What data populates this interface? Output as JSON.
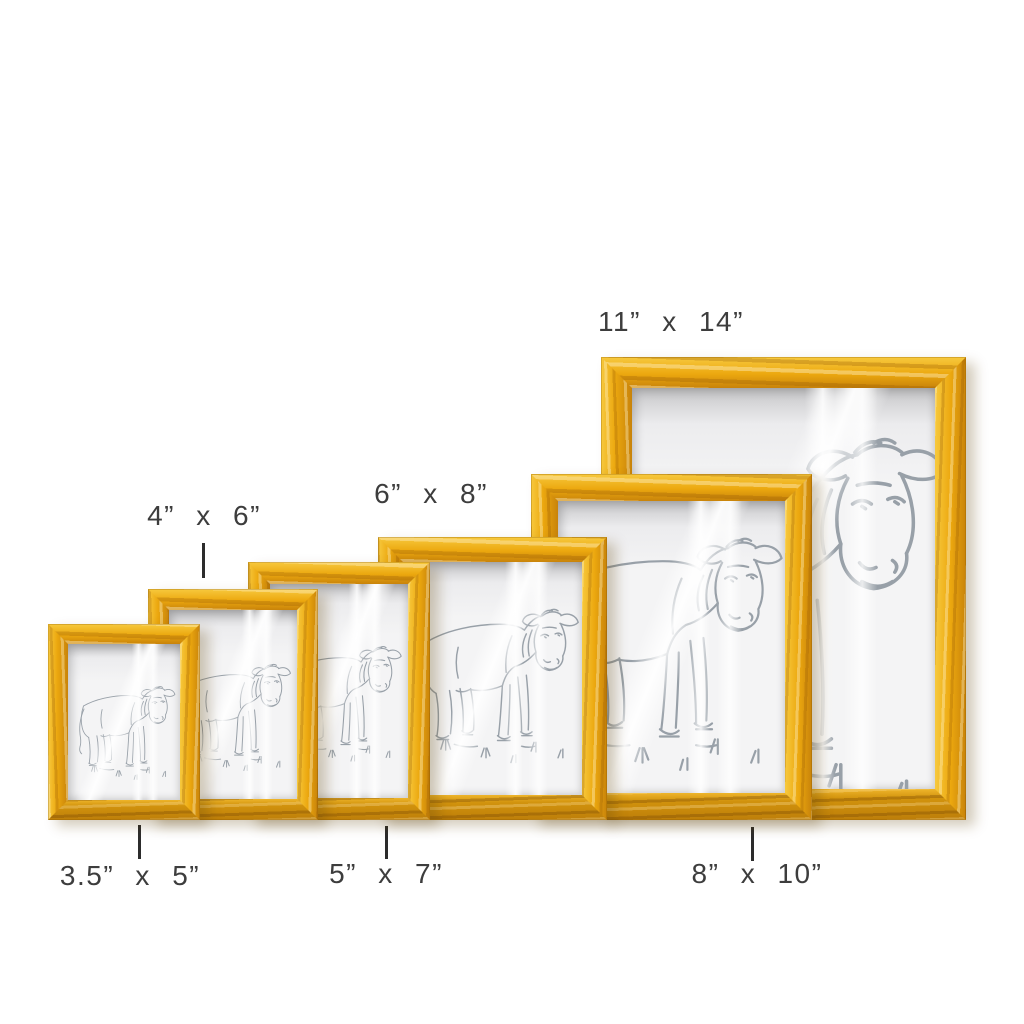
{
  "scene": {
    "background": "#ffffff",
    "artwork_subject": "pencil line sketch of a standing bull with grass tufts"
  },
  "colors": {
    "wood-light": "#f7c93e",
    "wood-main": "#eca80f",
    "wood-dark": "#c8830a",
    "wood-bottom": "#d2930d",
    "paper": "#f4f4f5",
    "paper-shadow": "#c6c6c8",
    "sketch": "#98a0a8",
    "label-text": "#3d3d3d",
    "pointer-line": "#2c2c2c",
    "background": "#ffffff"
  },
  "frames": [
    {
      "size_label": "3.5” x 5”",
      "label_placement": "below",
      "has_pointer_line": true
    },
    {
      "size_label": "4” x 6”",
      "label_placement": "above",
      "has_pointer_line": true
    },
    {
      "size_label": "5” x 7”",
      "label_placement": "below",
      "has_pointer_line": true
    },
    {
      "size_label": "6” x 8”",
      "label_placement": "above",
      "has_pointer_line": false
    },
    {
      "size_label": "8” x 10”",
      "label_placement": "below",
      "has_pointer_line": true
    },
    {
      "size_label": "11” x 14”",
      "label_placement": "above",
      "has_pointer_line": false
    }
  ]
}
